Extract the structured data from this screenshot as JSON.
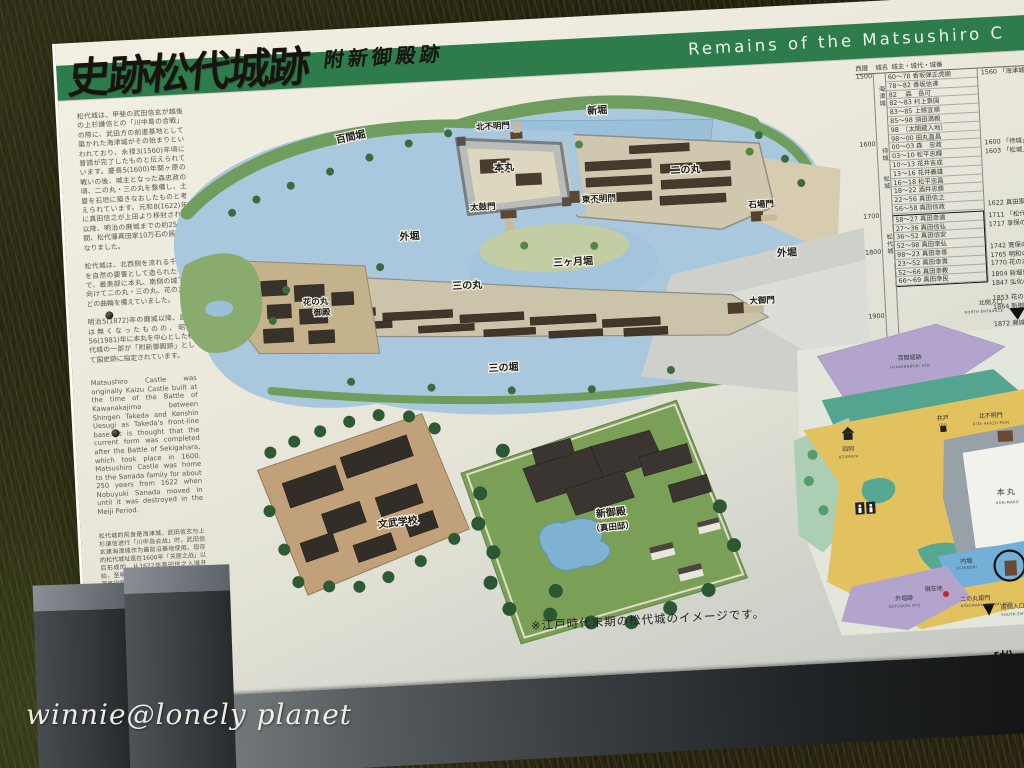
{
  "photo": {
    "watermark": "winnie@lonely planet"
  },
  "sign": {
    "title_jp": "史跡松代城跡",
    "subtitle_jp": "附新御殿跡",
    "banner_en": "Remains of the Matsushiro C",
    "intro": {
      "jp1": "松代城は、甲斐の武田信玄が越後の上杉謙信との「川中島の合戦」の際に、武田方の前進基地として築かれた海津城がその始まりといわれており、永禄3(1560)年頃に普請が完了したものと伝えられています。慶長5(1600)年関ヶ原の戦いの後、城主となった森忠政の頃、二の丸・三の丸を整備し、土塁を石垣に築きなおしたものと考えられています。元和8(1622)年に真田信之が上田より移封されて以降、明治の廃城までの約250年間、松代藩真田家10万石の居城となりました。",
      "jp2": "松代城は、北西側を流れる千曲川を自然の要害として造られた平城で、最奥部に本丸、南側の城下に向けて二の丸・三の丸、花の丸などの曲輪を備えていました。",
      "jp3": "明治5(1872)年の廃城以降、建物は無くなったものの、昭和56(1981)年に本丸を中心とした松代城の一部が「附新御殿跡」として国史跡に指定されています。",
      "en": "Matsushiro Castle was originally Kaizu Castle built at the time of the Battle of Kawanakajima between Shingen Takeda and Kenshin Uesugi as Takeda's front-line base. It is thought that the current form was completed after the Battle of Sekigahara, which took place in 1600. Matsushiro Castle was home to the Sanada family for about 250 years from 1622 when Nobuyuki Sanada moved in until it was destroyed in the Meiji Period.",
      "cn": "松代城的前身是海津城。武田信玄与上杉谦信进行「川中岛会战」时，武田信玄建海津城作为最前沿基地使用。现存的松代城址是在1600年「关原之战」以后形成的。从1622年真田信之入城开始，至明治废城为止约250年间是松代藩真田家的居城。",
      "credit": "長野市教育委員会"
    },
    "overview_map": {
      "labels": {
        "shinbori": "新堀",
        "hyakkenbori": "百間堀",
        "kita_akazumon": "北不明門",
        "honmaru": "本丸",
        "taikomon": "太鼓門",
        "higashi_akazumon": "東不明門",
        "ninomaru": "二の丸",
        "ishibamon": "石場門",
        "sotobori_east": "外堀",
        "sotobori_west": "外堀",
        "sannomaru": "三の丸",
        "mikazukibori": "三ヶ月堀",
        "oogomon": "大御門",
        "sannobori": "三の堀",
        "hananomaru_1": "花の丸",
        "hananomaru_2": "御殿"
      },
      "inset_school": "文武学校",
      "inset_goten_1": "新御殿",
      "inset_goten_2": "（真田邸）",
      "caption": "※江戸時代末期の松代城のイメージです。"
    },
    "chronology": {
      "headers": [
        "西暦",
        "城名",
        "城主・城代・城番"
      ],
      "eras": [
        "1500",
        "1600",
        "1700",
        "1800",
        "1900"
      ],
      "castles": [
        "海津城",
        "待城",
        "松城",
        "松代城"
      ],
      "rulers": [
        "60〜78 香坂弾正虎綱",
        "78〜82 香坂信達",
        "82　 森　長可",
        "82〜83 村上景国",
        "83〜85 上條宜順",
        "85〜98 須田満親",
        "98　〔太閤蔵入地〕",
        "98〜00 田丸直昌",
        "00〜03 森　忠政",
        "03〜10 松平忠輝",
        "10〜13 花井吉成",
        "13〜16 花井義雄",
        "16〜18 松平忠昌",
        "18〜22 酒井忠勝",
        "22〜56 真田信之",
        "56〜58 真田信政",
        "58〜27 真田幸道",
        "27〜36 真田信弘",
        "36〜52 真田信安",
        "52〜98 真田幸弘",
        "98〜23 真田幸専",
        "23〜52 真田幸貫",
        "52〜66 真田幸教",
        "66〜69 真田幸民"
      ],
      "events": [
        "1560 「海津城」",
        "1600 「待城」",
        "1603 「松城」",
        "1622 真田家が上田より",
        "1711 「松代城」",
        "1717 享保の大火",
        "1742 寛保の水害",
        "1765 明和の洪水",
        "1770 花の丸に御殿",
        "1804 新堀普請",
        "1847 弘化の地震",
        "1853 花の丸焼失",
        "1864 新御殿新築",
        "1872 廃城",
        "1873 花の丸焼失",
        "1981 国史跡指定"
      ]
    },
    "guide_map": {
      "north_entrance_jp": "北側入口",
      "north_entrance_en": "NORTH ENTRANCE",
      "hyakkenbori_jp": "百間堀跡",
      "hyakkenbori_en": "HYAKKENBORI ATO",
      "azumaya_jp": "四阿",
      "azumaya_en": "AZUMAYA",
      "ido_jp": "井戸",
      "ido_en": "IDO",
      "kita_akazumon_jp": "北不明門",
      "kita_akazumon_en": "KITA AKAZU MON",
      "honmaru_jp": "本丸",
      "honmaru_en": "HON-MARU",
      "uchibori_jp": "内堀",
      "uchibori_en": "UCHIBORI",
      "taikomon_jp": "太鼓門",
      "taikomon_en": "TAIKO MON",
      "minamimon_jp": "二の丸南門",
      "minamimon_en": "NINOMARU MINAMI MON",
      "current_location": "現在地",
      "sotobori_jp": "外堀跡",
      "sotobori_en": "SOTOBORI ATO",
      "south_entrance_jp": "南側入口",
      "south_entrance_en": "SOUTH ENTRANCE",
      "corner_text": "[松"
    },
    "colors": {
      "band_green": "#2e7c4c",
      "water_blue": "#a9c8de",
      "bank_green": "#6f9d5e",
      "path_yellow": "#e2c25e",
      "moat_purple": "#b2a4cd",
      "teal_green": "#53a58f",
      "current_red": "#cc2233"
    }
  }
}
